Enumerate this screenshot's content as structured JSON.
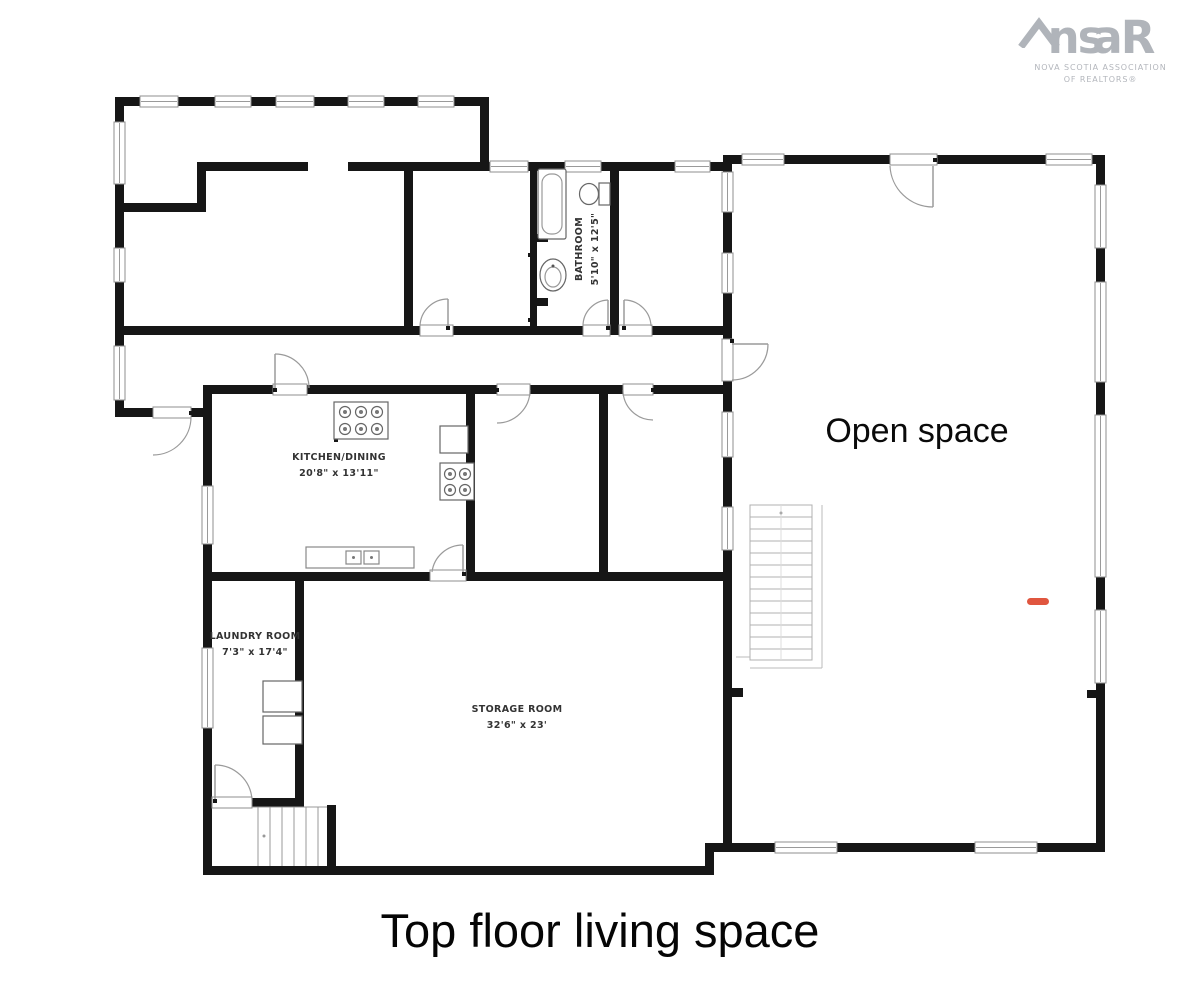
{
  "logo": {
    "text_left": "ns",
    "text_right": "aR",
    "tagline1": "NOVA SCOTIA ASSOCIATION",
    "tagline2": "OF REALTORS®"
  },
  "rooms": {
    "bathroom": {
      "name": "BATHROOM",
      "dims": "5'10\" x 12'5\""
    },
    "kitchen": {
      "name": "KITCHEN/DINING",
      "dims": "20'8\" x 13'11\""
    },
    "laundry": {
      "name": "LAUNDRY ROOM",
      "dims": "7'3\" x 17'4\""
    },
    "storage": {
      "name": "STORAGE ROOM",
      "dims": "32'6\" x 23'"
    },
    "open_space": {
      "name": "Open space"
    }
  },
  "caption": "Top floor living space",
  "colors": {
    "wall": "#161616",
    "accent_marker": "#e0563f",
    "logo": "#b0b4ba"
  }
}
